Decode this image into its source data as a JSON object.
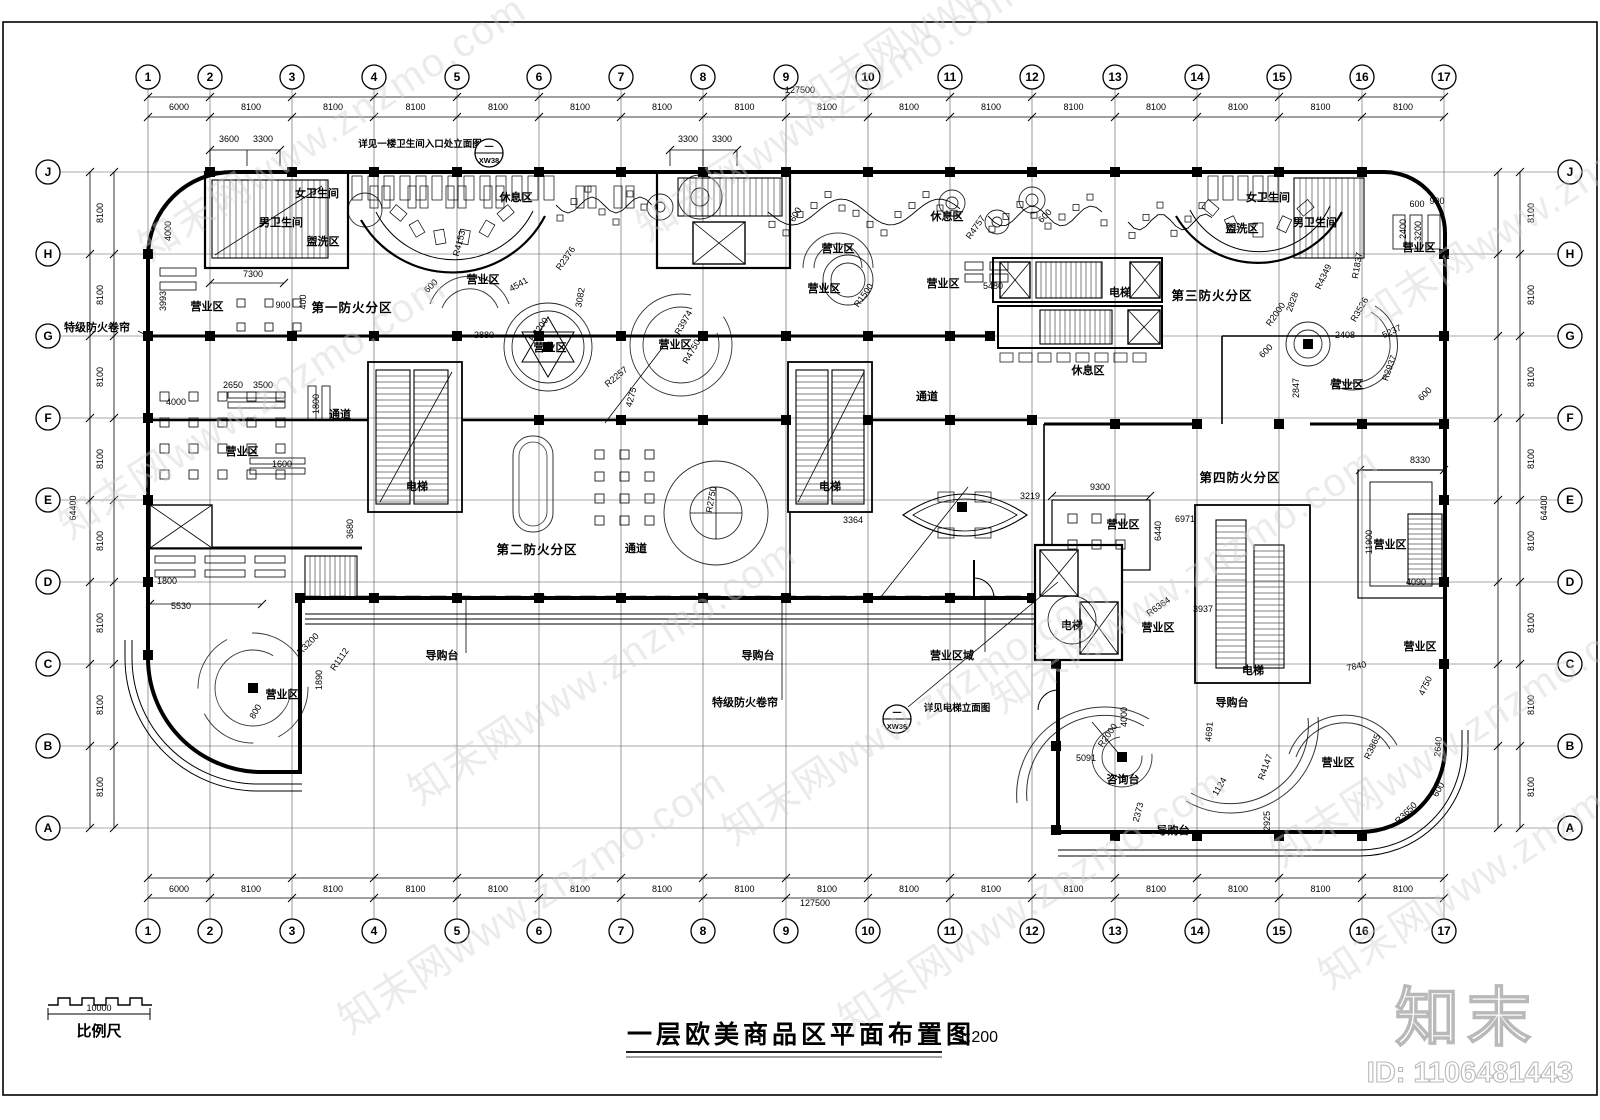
{
  "title": {
    "text": "一层欧美商品区平面布置图",
    "scale": "1:200"
  },
  "scale_bar": {
    "length": "10000",
    "label": "比例尺"
  },
  "branding": {
    "logo": "知末",
    "id_text": "ID: 1106481443"
  },
  "watermark": {
    "text": "知末网www.znzmo.com",
    "positions": [
      [
        150,
        262
      ],
      [
        70,
        540
      ],
      [
        420,
        806
      ],
      [
        648,
        242
      ],
      [
        734,
        846
      ],
      [
        1002,
        714
      ],
      [
        1372,
        332
      ],
      [
        1282,
        868
      ],
      [
        350,
        1035
      ],
      [
        850,
        1035
      ],
      [
        1330,
        990
      ],
      [
        806,
        118
      ]
    ]
  },
  "grid": {
    "col_labels": [
      "1",
      "2",
      "3",
      "4",
      "5",
      "6",
      "7",
      "8",
      "9",
      "10",
      "11",
      "12",
      "13",
      "14",
      "15",
      "16",
      "17"
    ],
    "col_x": [
      148,
      210,
      292,
      374,
      457,
      539,
      621,
      703,
      786,
      868,
      950,
      1032,
      1115,
      1197,
      1279,
      1362,
      1444
    ],
    "col_spacings": [
      "6000",
      "8100",
      "8100",
      "8100",
      "8100",
      "8100",
      "8100",
      "8100",
      "8100",
      "8100",
      "8100",
      "8100",
      "8100",
      "8100",
      "8100",
      "8100"
    ],
    "row_labels": [
      "J",
      "H",
      "G",
      "F",
      "E",
      "D",
      "C",
      "B",
      "A"
    ],
    "row_y": [
      172,
      254,
      336,
      418,
      500,
      582,
      664,
      746,
      828
    ],
    "row_spacings": [
      "8100",
      "8100",
      "8100",
      "8100",
      "8100",
      "8100",
      "8100",
      "8100"
    ],
    "total_width": "127500",
    "total_height": "64400"
  },
  "callouts": [
    {
      "x": 489,
      "y": 153,
      "top": "一",
      "bottom": "XW38"
    },
    {
      "x": 897,
      "y": 719,
      "top": "一",
      "bottom": "XW36"
    }
  ],
  "labels": [
    [
      "女卫生间",
      317,
      197,
      0,
      "lz"
    ],
    [
      "男卫生间",
      281,
      226,
      0,
      "lz"
    ],
    [
      "盥洗区",
      323,
      245,
      0,
      "lz"
    ],
    [
      "休息区",
      516,
      201,
      0,
      "lz"
    ],
    [
      "营业区",
      207,
      310,
      0,
      "lz"
    ],
    [
      "第一防火分区",
      352,
      312,
      0,
      "lf"
    ],
    [
      "营业区",
      483,
      283,
      0,
      "lz"
    ],
    [
      "营业区",
      550,
      351,
      0,
      "lz"
    ],
    [
      "营业区",
      675,
      348,
      0,
      "lz"
    ],
    [
      "通道",
      340,
      418,
      0,
      "lz"
    ],
    [
      "营业区",
      242,
      455,
      0,
      "lz"
    ],
    [
      "电梯",
      417,
      490,
      0,
      "lz"
    ],
    [
      "第二防火分区",
      537,
      554,
      0,
      "lf"
    ],
    [
      "通道",
      636,
      552,
      0,
      "lz"
    ],
    [
      "电梯",
      830,
      490,
      0,
      "lz"
    ],
    [
      "营业区",
      838,
      252,
      0,
      "lz"
    ],
    [
      "休息区",
      947,
      220,
      0,
      "lz"
    ],
    [
      "营业区",
      824,
      292,
      0,
      "lz"
    ],
    [
      "营业区",
      943,
      287,
      0,
      "lz"
    ],
    [
      "通道",
      927,
      400,
      0,
      "lz"
    ],
    [
      "休息区",
      1088,
      374,
      0,
      "lz"
    ],
    [
      "电梯",
      1120,
      296,
      0,
      "lz"
    ],
    [
      "第三防火分区",
      1212,
      300,
      0,
      "lf"
    ],
    [
      "女卫生间",
      1268,
      201,
      0,
      "lz"
    ],
    [
      "男卫生间",
      1315,
      226,
      0,
      "lz"
    ],
    [
      "盥洗区",
      1242,
      232,
      0,
      "lz"
    ],
    [
      "营业区",
      1419,
      251,
      0,
      "lz"
    ],
    [
      "营业区",
      1347,
      388,
      0,
      "lz"
    ],
    [
      "营业区",
      1123,
      528,
      0,
      "lz"
    ],
    [
      "第四防火分区",
      1240,
      482,
      0,
      "lf"
    ],
    [
      "营业区",
      1158,
      631,
      0,
      "lz"
    ],
    [
      "营业区",
      1390,
      548,
      0,
      "lz"
    ],
    [
      "电梯",
      1072,
      629,
      0,
      "lz"
    ],
    [
      "电梯",
      1253,
      674,
      0,
      "lz"
    ],
    [
      "营业区",
      1420,
      650,
      0,
      "lz"
    ],
    [
      "咨询台",
      1123,
      783,
      0,
      "lz"
    ],
    [
      "导购台",
      1232,
      706,
      0,
      "lz"
    ],
    [
      "营业区",
      1338,
      766,
      0,
      "lz"
    ],
    [
      "导购台",
      1173,
      834,
      0,
      "lz"
    ],
    [
      "导购台",
      758,
      659,
      0,
      "lz"
    ],
    [
      "营业区域",
      952,
      659,
      0,
      "lz"
    ],
    [
      "特级防火卷帘",
      745,
      706,
      0,
      "lz"
    ],
    [
      "导购台",
      442,
      659,
      0,
      "lz"
    ],
    [
      "营业区",
      282,
      698,
      0,
      "lz"
    ],
    [
      "特级防火卷帘",
      97,
      331,
      0,
      "lz"
    ],
    [
      "详见一楼卫生间入口处立面图",
      420,
      147,
      0,
      "ln"
    ],
    [
      "详见电梯立面图",
      957,
      711,
      0,
      "ln"
    ]
  ],
  "dims": [
    [
      "3600",
      229,
      142,
      0
    ],
    [
      "3300",
      263,
      142,
      0
    ],
    [
      "3300",
      688,
      142,
      0
    ],
    [
      "3300",
      722,
      142,
      0
    ],
    [
      "4000",
      171,
      231,
      -90
    ],
    [
      "7300",
      253,
      277,
      0
    ],
    [
      "3993",
      166,
      301,
      -90
    ],
    [
      "900",
      283,
      308,
      0
    ],
    [
      "400",
      306,
      302,
      -90
    ],
    [
      "R4153",
      462,
      244,
      -75
    ],
    [
      "4541",
      520,
      287,
      -30
    ],
    [
      "R2376",
      568,
      260,
      -55
    ],
    [
      "3082",
      583,
      298,
      -80
    ],
    [
      "600",
      433,
      288,
      -45
    ],
    [
      "3880",
      484,
      338,
      0
    ],
    [
      "R3200",
      541,
      331,
      -55
    ],
    [
      "R2257",
      618,
      379,
      -40
    ],
    [
      "4275",
      634,
      398,
      -75
    ],
    [
      "R3974",
      686,
      324,
      -60
    ],
    [
      "R4750",
      694,
      353,
      -60
    ],
    [
      "2650",
      233,
      388,
      0
    ],
    [
      "3500",
      263,
      388,
      0
    ],
    [
      "4000",
      176,
      405,
      0
    ],
    [
      "1800",
      319,
      404,
      -90
    ],
    [
      "1600",
      282,
      467,
      0
    ],
    [
      "3680",
      353,
      529,
      -90
    ],
    [
      "1800",
      167,
      584,
      0
    ],
    [
      "5530",
      181,
      609,
      0
    ],
    [
      "R3200",
      310,
      646,
      -45
    ],
    [
      "R1112",
      342,
      661,
      -55
    ],
    [
      "1890",
      322,
      680,
      -90
    ],
    [
      "800",
      258,
      713,
      -60
    ],
    [
      "R4757",
      978,
      229,
      -55
    ],
    [
      "600",
      798,
      216,
      -60
    ],
    [
      "600",
      1047,
      218,
      -45
    ],
    [
      "5480",
      993,
      289,
      0
    ],
    [
      "R1500",
      866,
      297,
      -55
    ],
    [
      "R2750",
      714,
      500,
      -80
    ],
    [
      "3364",
      853,
      523,
      0
    ],
    [
      "3219",
      1030,
      499,
      0
    ],
    [
      "9300",
      1100,
      490,
      0
    ],
    [
      "6971",
      1185,
      522,
      0
    ],
    [
      "6440",
      1161,
      531,
      -90
    ],
    [
      "R6364",
      1160,
      609,
      -35
    ],
    [
      "3937",
      1203,
      612,
      0
    ],
    [
      "8330",
      1420,
      463,
      0
    ],
    [
      "11900",
      1372,
      542,
      -90
    ],
    [
      "4090",
      1416,
      585,
      0
    ],
    [
      "7840",
      1357,
      669,
      -12
    ],
    [
      "4750",
      1428,
      687,
      -65
    ],
    [
      "R2000",
      1110,
      737,
      -55
    ],
    [
      "4000",
      1127,
      717,
      -90
    ],
    [
      "5091",
      1086,
      761,
      0
    ],
    [
      "2373",
      1141,
      813,
      -75
    ],
    [
      "4691",
      1212,
      732,
      -85
    ],
    [
      "1124",
      1222,
      788,
      -60
    ],
    [
      "R4147",
      1268,
      768,
      -70
    ],
    [
      "2925",
      1270,
      821,
      -90
    ],
    [
      "R3865",
      1375,
      748,
      -65
    ],
    [
      "2640",
      1441,
      747,
      -85
    ],
    [
      "600",
      1441,
      791,
      -60
    ],
    [
      "R3650",
      1408,
      815,
      -45
    ],
    [
      "R4349",
      1326,
      278,
      -65
    ],
    [
      "R1837",
      1360,
      266,
      -80
    ],
    [
      "2828",
      1295,
      303,
      -70
    ],
    [
      "R2000",
      1278,
      316,
      -55
    ],
    [
      "R3526",
      1362,
      311,
      -60
    ],
    [
      "2408",
      1345,
      338,
      0
    ],
    [
      "5237",
      1393,
      334,
      -25
    ],
    [
      "600",
      1268,
      353,
      -45
    ],
    [
      "R2937",
      1392,
      369,
      -70
    ],
    [
      "2847",
      1299,
      388,
      -90
    ],
    [
      "600",
      1427,
      396,
      -45
    ],
    [
      "600",
      1417,
      207,
      0
    ],
    [
      "900",
      1437,
      204,
      0
    ],
    [
      "2400",
      1406,
      229,
      -90
    ],
    [
      "3200",
      1421,
      231,
      -90
    ]
  ]
}
